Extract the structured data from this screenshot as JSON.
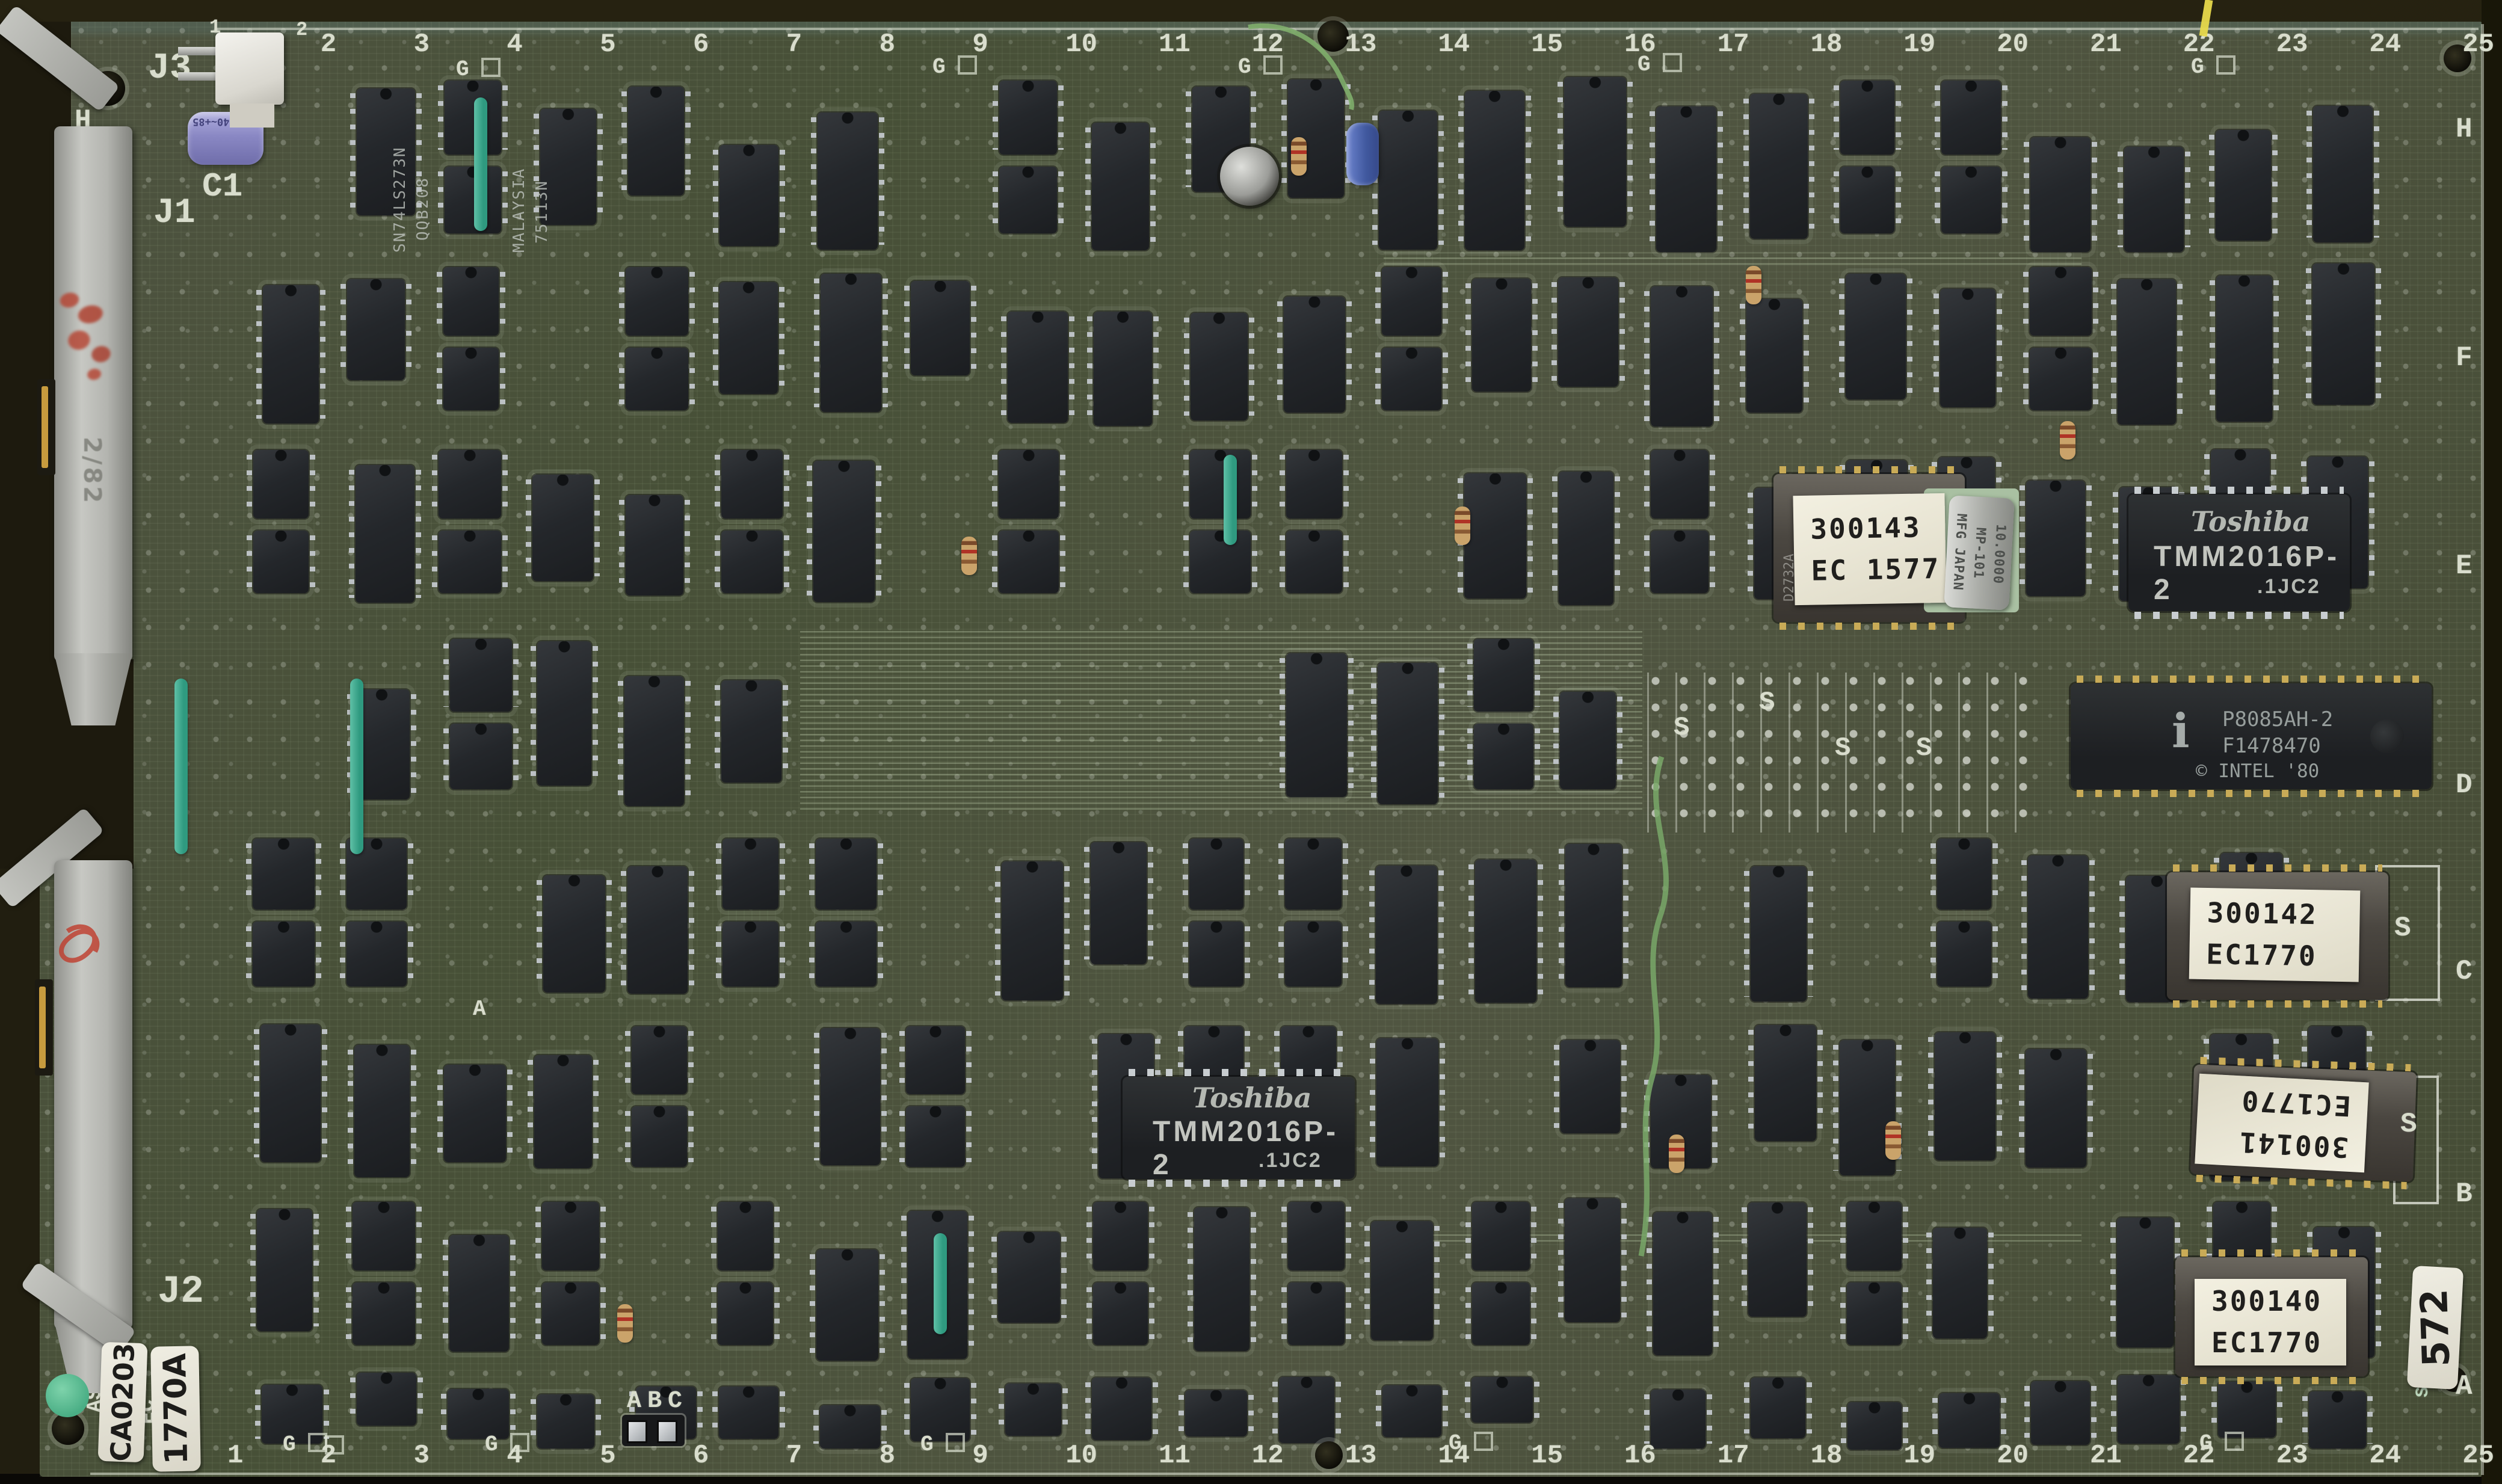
{
  "board": {
    "grid_numbers_top": [
      "1",
      "2",
      "3",
      "4",
      "5",
      "6",
      "7",
      "8",
      "9",
      "10",
      "11",
      "12",
      "13",
      "14",
      "15",
      "16",
      "17",
      "18",
      "19",
      "20",
      "21",
      "22",
      "23",
      "24",
      "25"
    ],
    "grid_numbers_bottom": [
      "1",
      "2",
      "3",
      "4",
      "5",
      "6",
      "7",
      "8",
      "9",
      "10",
      "11",
      "12",
      "13",
      "14",
      "15",
      "16",
      "17",
      "18",
      "19",
      "20",
      "21",
      "22",
      "23",
      "24",
      "25"
    ],
    "right_edge_letters": [
      "H",
      "F",
      "E",
      "D",
      "C",
      "B",
      "A"
    ],
    "left_edge_letter": "H",
    "ground_marker": "G",
    "spare_socket_marker": "S",
    "jumper_labels": "ABC",
    "section_marker_a": "A",
    "silk_asm": "ASM",
    "silk_ec": "EC",
    "silk_sn": "SN",
    "colors": {
      "board_green": "#4c523d",
      "silkscreen": "#d9ddcd",
      "chip_black": "#232528",
      "label_paper": "#efecdc",
      "bodge_wire_green": "#7fae6b",
      "yellow_mark": "#e7d94b"
    }
  },
  "connectors": {
    "j3": {
      "label": "J3",
      "pin_1": "1",
      "pin_2": "2"
    },
    "j1": {
      "label": "J1",
      "pencil_note": "2/82"
    },
    "j2": {
      "label": "J2"
    }
  },
  "capacitors": {
    "c1_label": "C1",
    "c1_marking": "-40~+85"
  },
  "crystal": {
    "frequency": "10.0000",
    "model": "MP-101",
    "origin": "MFG JAPAN"
  },
  "cpu": {
    "logo": "i",
    "part": "P8085AH-2",
    "lot": "F1478470",
    "copyright": "© INTEL '80"
  },
  "ram_chips": [
    {
      "brand": "Toshiba",
      "part": "TMM2016P-2",
      "code": ".1JC2"
    },
    {
      "brand": "Toshiba",
      "part": "TMM2016P-2",
      "code": ".1JC2"
    }
  ],
  "eproms": [
    {
      "line1": "300143",
      "line2": "EC 1577",
      "chip_marking": "D2732A"
    },
    {
      "line1": "300142",
      "line2": "EC1770"
    },
    {
      "line1": "300141",
      "line2": "EC1770"
    },
    {
      "line1": "300140",
      "line2": "EC1770"
    }
  ],
  "logic_chip_markings": {
    "chip1_part": "SN74LS273N",
    "chip1_lot": "QQB208",
    "chip2_origin": "MALAYSIA",
    "chip2_part": "75113N"
  },
  "stickers": {
    "asm_number": "CA0203",
    "ec_number": "1770A",
    "serial": "572"
  }
}
